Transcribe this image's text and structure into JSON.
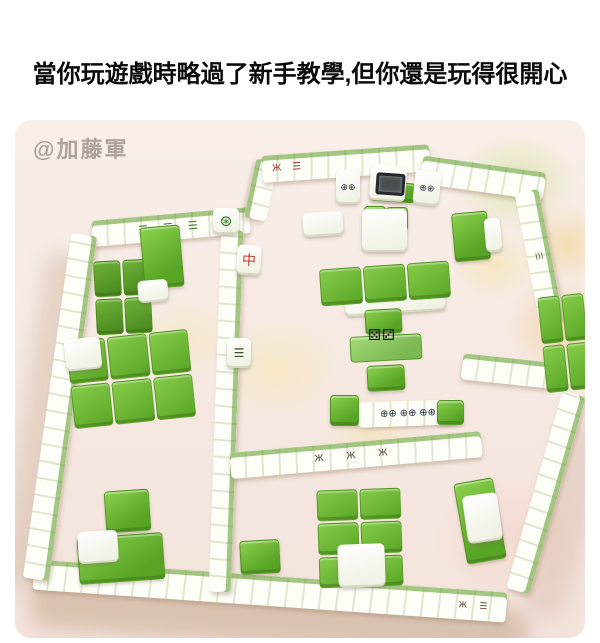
{
  "meme": {
    "caption": "當你玩遊戲時略過了新手教學,但你還是玩得很開心"
  },
  "photo": {
    "watermark": "@加藤軍",
    "subject": "mahjong tiles arranged as an apartment floor plan maze on a pink carpet",
    "colors": {
      "tile_green": "#68b02f",
      "tile_white": "#fbfcf3",
      "carpet_pink": "#f7ece7",
      "blob_orange": "#f0c48c",
      "blob_yellow": "#f2e3ae"
    }
  },
  "tile_faces": {
    "dot_pair": "⊕⊕",
    "counter_dots": "⊕⊕ ⊕⊕ ⊕⊕",
    "flower": "⊛",
    "red_center": "中",
    "bamboo_row": "☰ ☰ ☰",
    "bamboo_single": "☰",
    "character_row": "Ж  Ж  Ж",
    "character_end": "Ж ☰",
    "side_marks": "☰",
    "dice_pair": "⚄⚂"
  }
}
